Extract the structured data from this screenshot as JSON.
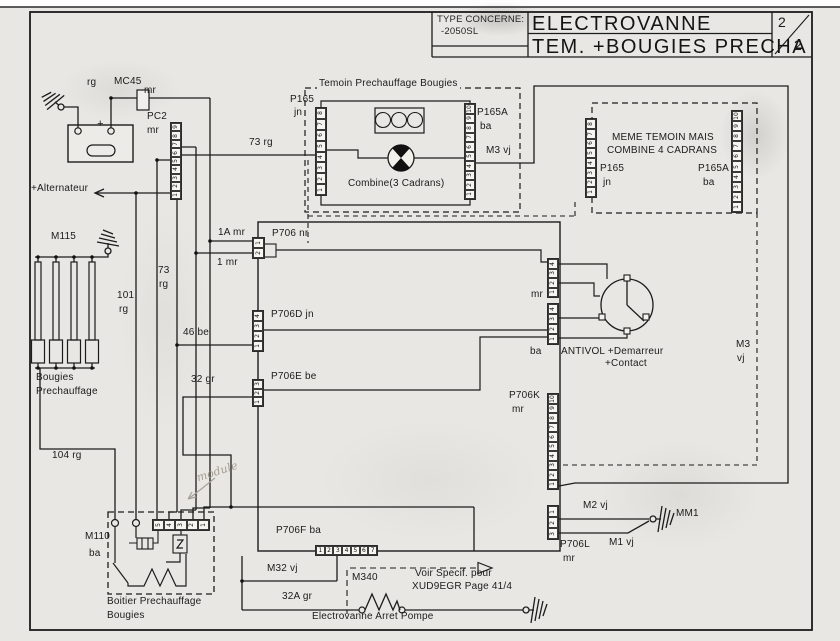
{
  "page": {
    "background": "#e8e7e3",
    "ink": "#1c1c1c"
  },
  "title_block": {
    "type_label": "TYPE CONCERNE:",
    "type_value": "-2050SL",
    "title_line1": "ELECTROVANNE",
    "title_line2": "TEM. +BOUGIES PRECHA",
    "page_number": "2",
    "page_total": "2"
  },
  "battery": {
    "minus_label": "-",
    "plus_label": "+"
  },
  "labels": {
    "rg_top": "rg",
    "mc45": "MC45",
    "mc45_color": "mr",
    "pc2": "PC2",
    "pc2_color": "mr",
    "alternateur": "+Alternateur",
    "m115": "M115",
    "w73rg_h": "73 rg",
    "w73_v": "73",
    "w73_vc": "rg",
    "w101": "101",
    "w101c": "rg",
    "bougies_1": "Bougies",
    "bougies_2": "Prechauffage",
    "w104rg": "104 rg",
    "w1a_mr": "1A mr",
    "p706_nr": "P706 nr",
    "w1_mr": "1 mr",
    "p706d_jn": "P706D jn",
    "w46be": "46 be",
    "p706e_be": "P706E be",
    "w32gr": "32 gr",
    "temoin_title": "Temoin Prechauffage Bougies",
    "p165": "P165",
    "p165_color": "jn",
    "p165a": "P165A",
    "p165a_color": "ba",
    "combine_caption": "Combine(3 Cadrans)",
    "m3vj_top": "M3 vj",
    "meme_line1": "MEME TEMOIN MAIS",
    "meme_line2": "COMBINE 4 CADRANS",
    "p165_m": "P165",
    "p165_m_color": "jn",
    "p165a_m": "P165A",
    "p165a_m_color": "ba",
    "m3_right_1": "M3",
    "m3_right_2": "vj",
    "antivol_mr": "mr",
    "antivol_ba": "ba",
    "antivol_line1": "ANTIVOL +Demarreur",
    "antivol_line2": "+Contact",
    "p706k": "P706K",
    "p706k_color": "mr",
    "m2vj": "M2 vj",
    "mm1": "MM1",
    "m1vj": "M1 vj",
    "p706l": "P706L",
    "p706l_color": "mr",
    "p706f_ba": "P706F ba",
    "m32vj": "M32 vj",
    "m340": "M340",
    "w32agr": "32A gr",
    "voir_line1": "Voir Specif. pour",
    "voir_line2": "XUD9EGR Page 41/4",
    "electrovanne": "Electrovanne Arret Pompe",
    "m110": "M110",
    "m110_color": "ba",
    "boitier_line1": "Boitier Prechauffage",
    "boitier_line2": "Bougies",
    "handwritten": "module"
  },
  "strips": {
    "pc2": [
      "9",
      "8",
      "7",
      "6",
      "5",
      "4",
      "3",
      "2",
      "1"
    ],
    "p165_1": [
      "8",
      "7",
      "6",
      "5",
      "4",
      "3",
      "2",
      "1"
    ],
    "p165a_1": [
      "10",
      "9",
      "8",
      "7",
      "6",
      "5",
      "4",
      "3",
      "2",
      "1"
    ],
    "p165_2": [
      "8",
      "7",
      "6",
      "5",
      "4",
      "3",
      "2",
      "1"
    ],
    "p165a_2": [
      "10",
      "9",
      "8",
      "7",
      "6",
      "5",
      "4",
      "3",
      "2",
      "1"
    ],
    "p706": [
      "1",
      "2"
    ],
    "p706d": [
      "4",
      "3",
      "2",
      "1"
    ],
    "p706e": [
      "3",
      "2",
      "1"
    ],
    "antivol_mr": [
      "4",
      "3",
      "2",
      "1"
    ],
    "antivol_ba": [
      "4",
      "3",
      "2",
      "1"
    ],
    "p706k": [
      "10",
      "9",
      "8",
      "7",
      "6",
      "5",
      "4",
      "3",
      "2",
      "1"
    ],
    "p706l": [
      "1",
      "2",
      "3"
    ],
    "p706f": [
      "1",
      "2",
      "3",
      "4",
      "5",
      "6",
      "7"
    ],
    "boitier": [
      "5",
      "4",
      "3",
      "2",
      "1"
    ]
  }
}
